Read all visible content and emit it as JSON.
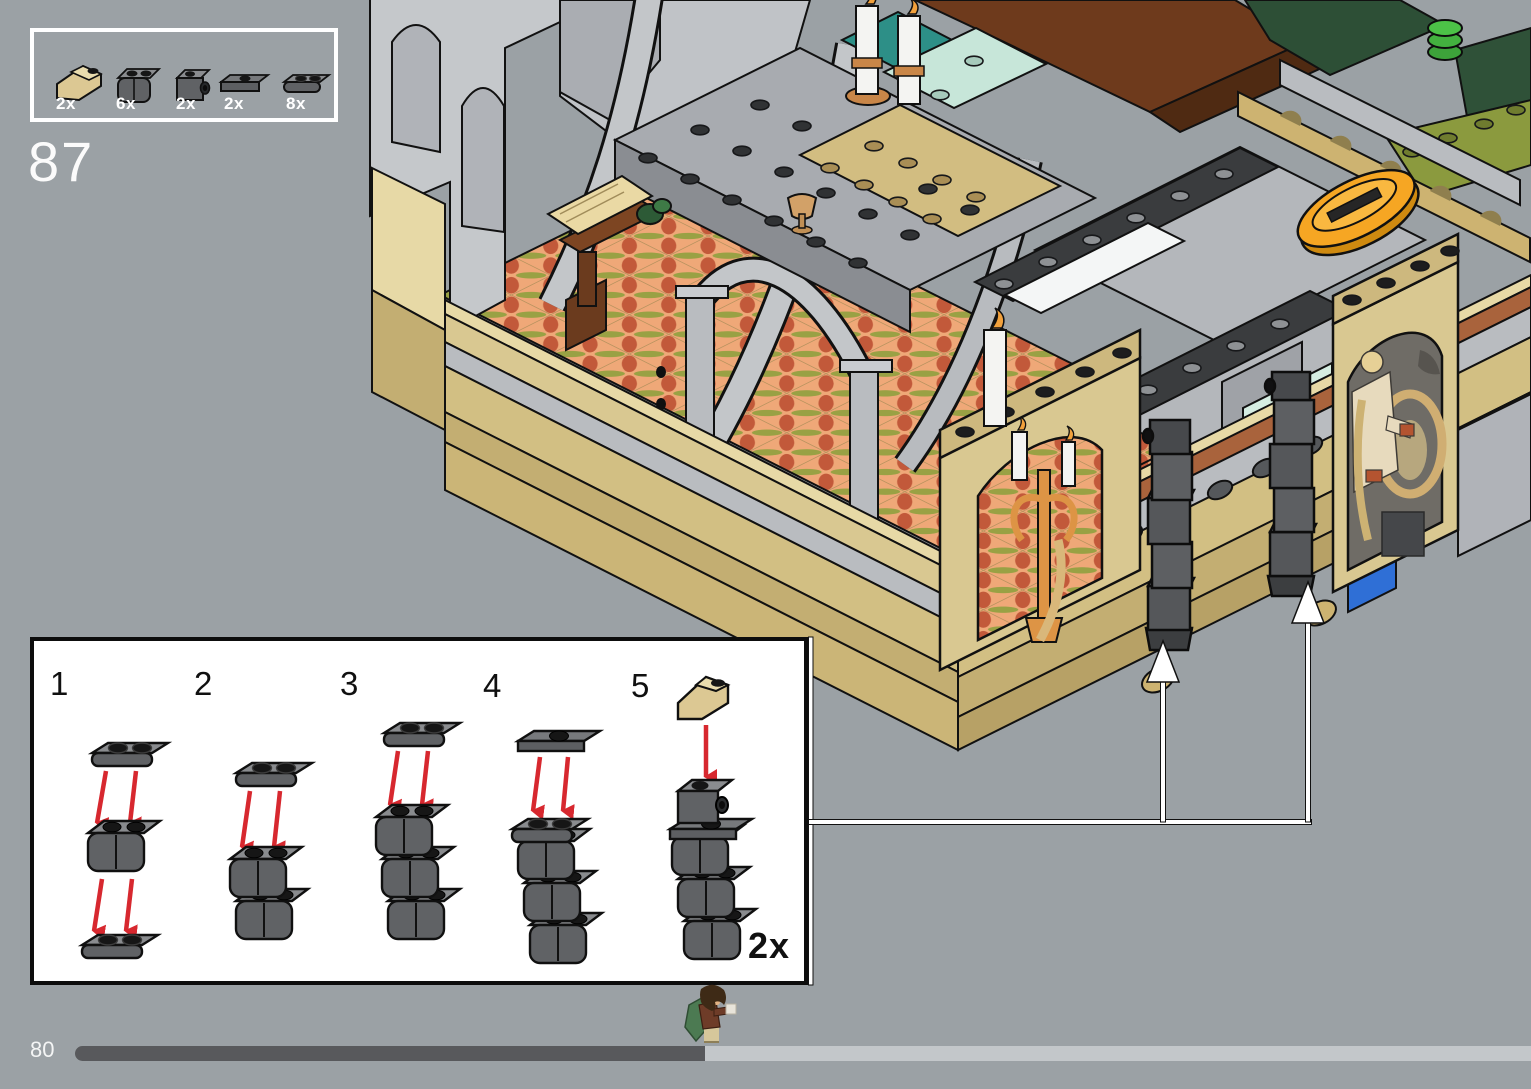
{
  "page": {
    "step_number": "87",
    "page_number": "80",
    "background_color": "#9ba1a5",
    "progress": {
      "fraction": 0.43,
      "bar_dark_color": "#58595c",
      "bar_light_color": "#c3c7ca",
      "marker": "frodo-minifigure"
    }
  },
  "parts_callout": {
    "items": [
      {
        "icon": "tan-inverted-slope-brick-icon",
        "count": "2x",
        "color": "#dcc893"
      },
      {
        "icon": "dark-gray-palisade-brick-icon",
        "count": "6x",
        "color": "#606265"
      },
      {
        "icon": "dark-gray-headlight-brick-icon",
        "count": "2x",
        "color": "#606265"
      },
      {
        "icon": "dark-gray-jumper-plate-icon",
        "count": "2x",
        "color": "#606265"
      },
      {
        "icon": "dark-gray-rounded-plate-icon",
        "count": "8x",
        "color": "#606265"
      }
    ]
  },
  "substeps": {
    "steps": [
      {
        "number": "1"
      },
      {
        "number": "2"
      },
      {
        "number": "3"
      },
      {
        "number": "4"
      },
      {
        "number": "5"
      }
    ],
    "quantity_label": "2x",
    "arrow_color": "#d7282f"
  },
  "model_render": {
    "subject": "lego-rivendell-hall-isometric-render",
    "callout_arrows": 2,
    "palette": {
      "stone_light": "#c5c8cb",
      "stone_mid": "#aaadb2",
      "stone_dark": "#8a8d92",
      "tan": "#d9c891",
      "mosaic_peach": "#efa878",
      "mosaic_rust": "#c2593a",
      "mosaic_olive": "#99a144",
      "roof_brown": "#6e3a1c",
      "dark_green": "#2d4f36",
      "teal": "#2d8f87",
      "seafoam": "#c7e6d9",
      "boat_orange": "#f6a623",
      "blue_tile": "#2f6fd6",
      "dark_plate": "#3a3c3e",
      "column_gray": "#55575a"
    }
  }
}
